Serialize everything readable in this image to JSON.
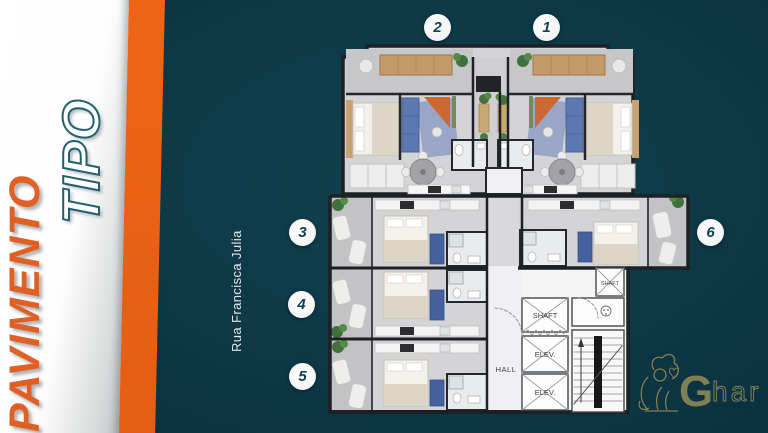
{
  "slide": {
    "title_primary": "PAVIMENTO",
    "title_secondary": "TIPO",
    "street_label": "Rua Francisca Julia"
  },
  "unit_markers": [
    "1",
    "2",
    "3",
    "4",
    "5",
    "6"
  ],
  "floor_plan": {
    "labels": {
      "shaft_small": "SHAFT",
      "shaft": "SHAFT",
      "elevator_top": "ELEV.",
      "elevator_bottom": "ELEV.",
      "hall": "HALL"
    }
  },
  "watermark": {
    "logo_g": "G",
    "logo_rest": "har"
  },
  "colors": {
    "background_teal": "#0e3a4a",
    "accent_orange": "#e2601f",
    "title_orange": "#e05f22",
    "title_outline_teal": "#25606f",
    "marker_text_teal": "#11404f",
    "watermark_gold": "#8d8757",
    "plan_sofa_blue": "#5d78b0",
    "plan_accent_orange": "#cd6832"
  }
}
